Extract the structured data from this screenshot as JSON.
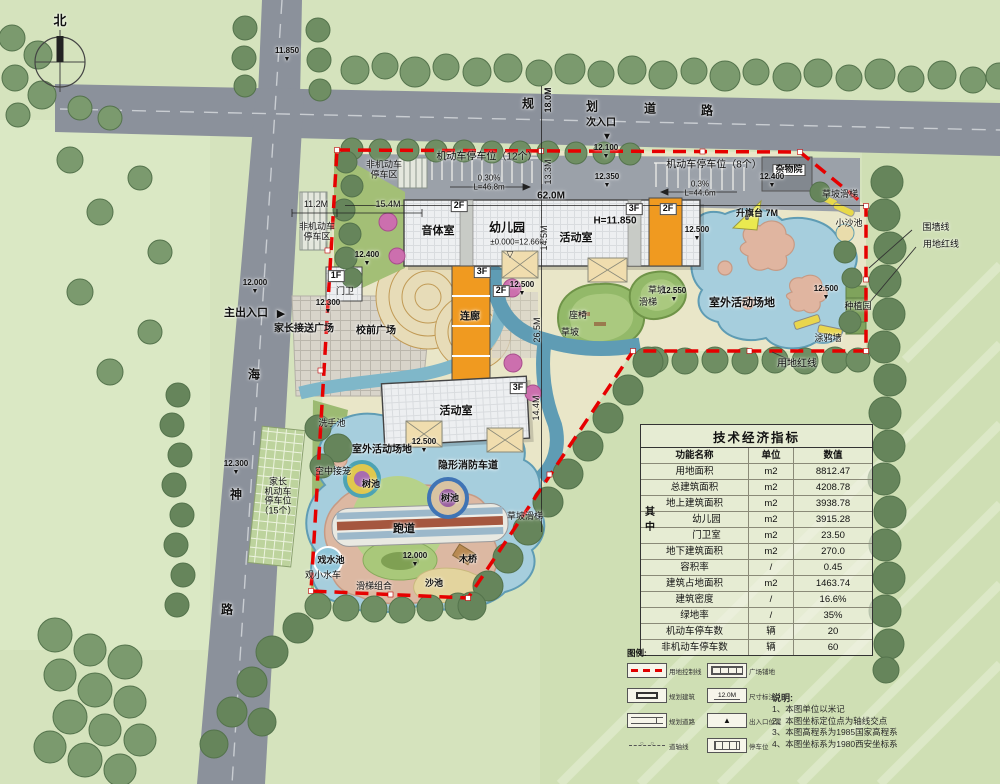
{
  "colors": {
    "boundary_red": "#e60000",
    "water": "#a6cedd",
    "building_orange": "#f09a20",
    "road_gray": "#8b919b"
  },
  "table": {
    "title": "技术经济指标",
    "headers": [
      "功能名称",
      "单位",
      "数值"
    ],
    "group": "其中",
    "rows": [
      {
        "name": "用地面积",
        "unit": "m2",
        "value": "8812.47"
      },
      {
        "name": "总建筑面积",
        "unit": "m2",
        "value": "4208.78"
      },
      {
        "name": "地上建筑面积",
        "unit": "m2",
        "value": "3938.78"
      },
      {
        "name": "幼儿园",
        "unit": "m2",
        "value": "3915.28",
        "group": true
      },
      {
        "name": "门卫室",
        "unit": "m2",
        "value": "23.50",
        "group": true
      },
      {
        "name": "地下建筑面积",
        "unit": "m2",
        "value": "270.0"
      },
      {
        "name": "容积率",
        "unit": "/",
        "value": "0.45"
      },
      {
        "name": "建筑占地面积",
        "unit": "m2",
        "value": "1463.74"
      },
      {
        "name": "建筑密度",
        "unit": "/",
        "value": "16.6%"
      },
      {
        "name": "绿地率",
        "unit": "/",
        "value": "35%"
      },
      {
        "name": "机动车停车数",
        "unit": "辆",
        "value": "20"
      },
      {
        "name": "非机动车停车数",
        "unit": "辆",
        "value": "60"
      }
    ]
  },
  "legend": {
    "title": "图例:",
    "items": [
      {
        "label": "用地控制线",
        "icon": "red-dashed-line"
      },
      {
        "label": "规划建筑",
        "icon": "building-outline"
      },
      {
        "label": "规划道路",
        "icon": "road-symbol"
      },
      {
        "label": "道轴线",
        "icon": "axis-line"
      },
      {
        "label": "广场铺地",
        "icon": "paving-grid"
      },
      {
        "label": "尺寸标注",
        "icon": "dimension",
        "text": "12.0M"
      },
      {
        "label": "出入口位置",
        "icon": "entrance-triangle"
      },
      {
        "label": "停车位",
        "icon": "parking-stripes"
      }
    ]
  },
  "notes": {
    "title": "说明:",
    "lines": [
      "1、本图单位以米记",
      "2、本图坐标定位点为轴线交点",
      "3、本图高程系为1985国家高程系",
      "4、本图坐标系为1980西安坐标系"
    ]
  },
  "map_labels": [
    {
      "t": "北",
      "x": 60,
      "y": 21,
      "fs": 13,
      "cls": "b",
      "nm": "north-label"
    },
    {
      "t": "11.850",
      "x": 287,
      "y": 55,
      "cls": "elev",
      "nm": "elevation-marker"
    },
    {
      "t": "规",
      "x": 528,
      "y": 104,
      "fs": 12,
      "cls": "b",
      "nm": "road-name-char"
    },
    {
      "t": "划",
      "x": 592,
      "y": 107,
      "fs": 12,
      "cls": "b",
      "nm": "road-name-char"
    },
    {
      "t": "道",
      "x": 650,
      "y": 109,
      "fs": 12,
      "cls": "b",
      "nm": "road-name-char"
    },
    {
      "t": "路",
      "x": 707,
      "y": 111,
      "fs": 12,
      "cls": "b",
      "nm": "road-name-char"
    },
    {
      "t": "18.0M",
      "x": 549,
      "y": 100,
      "cls": "r90 b",
      "nm": "road-width-dim"
    },
    {
      "t": "次入口",
      "x": 601,
      "y": 124,
      "fs": 10,
      "cls": "b",
      "nm": "secondary-entrance-label"
    },
    {
      "t": "▼",
      "x": 607,
      "y": 138,
      "fs": 10,
      "nm": "secondary-entrance-arrow-icon"
    },
    {
      "t": "12.100",
      "x": 606,
      "y": 152,
      "cls": "elev",
      "nm": "elevation-marker"
    },
    {
      "t": "12.350",
      "x": 607,
      "y": 181,
      "cls": "elev",
      "nm": "elevation-marker"
    },
    {
      "t": "12.000",
      "x": 255,
      "y": 287,
      "cls": "elev",
      "nm": "elevation-marker"
    },
    {
      "t": "主出入口",
      "x": 246,
      "y": 314,
      "fs": 11,
      "cls": "b",
      "nm": "main-entrance-label"
    },
    {
      "t": "▶",
      "x": 281,
      "y": 315,
      "fs": 11,
      "nm": "main-entrance-arrow-icon"
    },
    {
      "t": "海",
      "x": 254,
      "y": 375,
      "fs": 12,
      "cls": "b",
      "nm": "road-name-char"
    },
    {
      "t": "神",
      "x": 236,
      "y": 495,
      "fs": 12,
      "cls": "b",
      "nm": "road-name-char"
    },
    {
      "t": "路",
      "x": 227,
      "y": 610,
      "fs": 12,
      "cls": "b",
      "nm": "road-name-char"
    },
    {
      "t": "12.300",
      "x": 236,
      "y": 468,
      "cls": "elev",
      "nm": "elevation-marker"
    },
    {
      "t": "非机动车\n停车区",
      "x": 384,
      "y": 170,
      "cls": "pre",
      "nm": "area-label"
    },
    {
      "t": "机动车停车位（12个）",
      "x": 487,
      "y": 158,
      "fs": 10,
      "nm": "parking-label"
    },
    {
      "t": "0.30%",
      "x": 489,
      "y": 179,
      "fs": 8,
      "nm": "slope-label"
    },
    {
      "t": "L=46.8m",
      "x": 489,
      "y": 188,
      "fs": 8,
      "nm": "slope-label"
    },
    {
      "t": "13.3M",
      "x": 549,
      "y": 172,
      "cls": "r90",
      "nm": "dimension-label"
    },
    {
      "t": "机动车停车位（8个）",
      "x": 714,
      "y": 166,
      "fs": 10,
      "nm": "parking-label"
    },
    {
      "t": "0.3%",
      "x": 700,
      "y": 185,
      "fs": 8,
      "nm": "slope-label"
    },
    {
      "t": "L=44.6m",
      "x": 700,
      "y": 194,
      "fs": 8,
      "nm": "slope-label"
    },
    {
      "t": "杂物院",
      "x": 789,
      "y": 170,
      "fs": 9,
      "cls": "chip",
      "nm": "yard-label"
    },
    {
      "t": "12.400",
      "x": 772,
      "y": 181,
      "cls": "elev",
      "nm": "elevation-marker"
    },
    {
      "t": "非机动车\n停车区",
      "x": 317,
      "y": 232,
      "cls": "pre",
      "nm": "area-label"
    },
    {
      "t": "11.2M",
      "x": 316,
      "y": 205,
      "nm": "dimension-label"
    },
    {
      "t": "15.4M",
      "x": 388,
      "y": 205,
      "nm": "dimension-label"
    },
    {
      "t": "12.400",
      "x": 367,
      "y": 259,
      "cls": "elev",
      "nm": "elevation-marker"
    },
    {
      "t": "2F",
      "x": 459,
      "y": 206,
      "cls": "chip",
      "nm": "floor-label"
    },
    {
      "t": "62.0M",
      "x": 551,
      "y": 197,
      "fs": 10,
      "cls": "b",
      "nm": "dimension-label"
    },
    {
      "t": "3F",
      "x": 634,
      "y": 209,
      "cls": "chip",
      "nm": "floor-label"
    },
    {
      "t": "2F",
      "x": 668,
      "y": 209,
      "cls": "chip",
      "nm": "floor-label"
    },
    {
      "t": "音体室",
      "x": 438,
      "y": 232,
      "fs": 11,
      "cls": "b",
      "nm": "room-label"
    },
    {
      "t": "幼儿园",
      "x": 507,
      "y": 228,
      "fs": 12,
      "cls": "b",
      "nm": "building-label"
    },
    {
      "t": "±0.000=12.660",
      "x": 517,
      "y": 243,
      "cls": "datum",
      "nm": "datum-label"
    },
    {
      "t": "▽",
      "x": 510,
      "y": 255,
      "fs": 9,
      "nm": "datum-marker-icon"
    },
    {
      "t": "14.5M",
      "x": 545,
      "y": 238,
      "cls": "r90",
      "nm": "dimension-label"
    },
    {
      "t": "H=11.850",
      "x": 615,
      "y": 222,
      "fs": 10,
      "cls": "b",
      "nm": "height-label"
    },
    {
      "t": "活动室",
      "x": 576,
      "y": 239,
      "fs": 11,
      "cls": "b",
      "nm": "room-label"
    },
    {
      "t": "12.500",
      "x": 522,
      "y": 289,
      "cls": "elev",
      "nm": "elevation-marker"
    },
    {
      "t": "3F",
      "x": 482,
      "y": 272,
      "cls": "chip",
      "nm": "floor-label"
    },
    {
      "t": "2F",
      "x": 501,
      "y": 291,
      "cls": "chip",
      "nm": "floor-label"
    },
    {
      "t": "连廊",
      "x": 470,
      "y": 318,
      "fs": 10,
      "cls": "b",
      "nm": "corridor-label"
    },
    {
      "t": "1F",
      "x": 336,
      "y": 276,
      "cls": "chip",
      "nm": "floor-label"
    },
    {
      "t": "门卫",
      "x": 345,
      "y": 292,
      "nm": "gatehouse-label"
    },
    {
      "t": "12.300",
      "x": 328,
      "y": 307,
      "cls": "elev",
      "nm": "elevation-marker"
    },
    {
      "t": "家长接送广场",
      "x": 304,
      "y": 330,
      "fs": 10,
      "cls": "b",
      "nm": "plaza-label"
    },
    {
      "t": "校前广场",
      "x": 376,
      "y": 332,
      "fs": 10,
      "cls": "b",
      "nm": "plaza-label"
    },
    {
      "t": "升旗台 7M",
      "x": 757,
      "y": 214,
      "cls": "b",
      "nm": "flag-platform-label"
    },
    {
      "t": "草坡滑梯",
      "x": 840,
      "y": 195,
      "nm": "feature-label"
    },
    {
      "t": "小沙池",
      "x": 849,
      "y": 224,
      "nm": "feature-label"
    },
    {
      "t": "围墙线",
      "x": 936,
      "y": 228,
      "nm": "annotation-label"
    },
    {
      "t": "用地红线",
      "x": 941,
      "y": 245,
      "nm": "annotation-label"
    },
    {
      "t": "12.500",
      "x": 697,
      "y": 234,
      "cls": "elev",
      "nm": "elevation-marker"
    },
    {
      "t": "室外活动场地",
      "x": 742,
      "y": 304,
      "fs": 11,
      "cls": "b",
      "nm": "area-label"
    },
    {
      "t": "草坡",
      "x": 657,
      "y": 291,
      "nm": "feature-label"
    },
    {
      "t": "滑梯",
      "x": 648,
      "y": 303,
      "nm": "feature-label"
    },
    {
      "t": "12.550",
      "x": 674,
      "y": 295,
      "cls": "elev",
      "nm": "elevation-marker"
    },
    {
      "t": "12.500",
      "x": 826,
      "y": 293,
      "cls": "elev",
      "nm": "elevation-marker"
    },
    {
      "t": "种植园",
      "x": 858,
      "y": 307,
      "nm": "feature-label"
    },
    {
      "t": "涂鸦墙",
      "x": 828,
      "y": 339,
      "nm": "feature-label"
    },
    {
      "t": "用地红线",
      "x": 797,
      "y": 365,
      "fs": 10,
      "nm": "annotation-label"
    },
    {
      "t": "座椅",
      "x": 578,
      "y": 316,
      "nm": "feature-label"
    },
    {
      "t": "草坡",
      "x": 570,
      "y": 333,
      "nm": "feature-label"
    },
    {
      "t": "26.5M",
      "x": 538,
      "y": 330,
      "cls": "r90",
      "nm": "dimension-label"
    },
    {
      "t": "3F",
      "x": 518,
      "y": 388,
      "cls": "chip",
      "nm": "floor-label"
    },
    {
      "t": "14.4M",
      "x": 537,
      "y": 408,
      "cls": "r90",
      "nm": "dimension-label"
    },
    {
      "t": "活动室",
      "x": 456,
      "y": 412,
      "fs": 11,
      "cls": "b",
      "nm": "room-label"
    },
    {
      "t": "洗手池",
      "x": 332,
      "y": 424,
      "nm": "feature-label"
    },
    {
      "t": "室外活动场地",
      "x": 382,
      "y": 451,
      "fs": 10,
      "cls": "b",
      "nm": "area-label"
    },
    {
      "t": "12.500",
      "x": 424,
      "y": 446,
      "cls": "elev",
      "nm": "elevation-marker"
    },
    {
      "t": "隐形消防车道",
      "x": 468,
      "y": 467,
      "fs": 10,
      "cls": "b",
      "nm": "fire-lane-label"
    },
    {
      "t": "空中接笼",
      "x": 333,
      "y": 472,
      "nm": "feature-label"
    },
    {
      "t": "树池",
      "x": 371,
      "y": 485,
      "cls": "b",
      "nm": "tree-pool-label"
    },
    {
      "t": "树池",
      "x": 450,
      "y": 499,
      "cls": "b",
      "nm": "tree-pool-label"
    },
    {
      "t": "家长\n机动车\n停车位\n（15个）",
      "x": 278,
      "y": 497,
      "cls": "pre",
      "nm": "parking-label"
    },
    {
      "t": "跑道",
      "x": 404,
      "y": 530,
      "fs": 11,
      "cls": "b",
      "nm": "track-label"
    },
    {
      "t": "草坡滑梯",
      "x": 525,
      "y": 517,
      "nm": "feature-label"
    },
    {
      "t": "木桥",
      "x": 468,
      "y": 560,
      "cls": "b",
      "nm": "feature-label"
    },
    {
      "t": "戏水池",
      "x": 331,
      "y": 561,
      "cls": "b",
      "nm": "feature-label"
    },
    {
      "t": "观小水车",
      "x": 323,
      "y": 576,
      "nm": "feature-label"
    },
    {
      "t": "滑梯组合",
      "x": 374,
      "y": 587,
      "nm": "feature-label"
    },
    {
      "t": "沙池",
      "x": 434,
      "y": 584,
      "cls": "b",
      "nm": "feature-label"
    },
    {
      "t": "12.000",
      "x": 415,
      "y": 560,
      "cls": "elev",
      "nm": "elevation-marker"
    }
  ]
}
